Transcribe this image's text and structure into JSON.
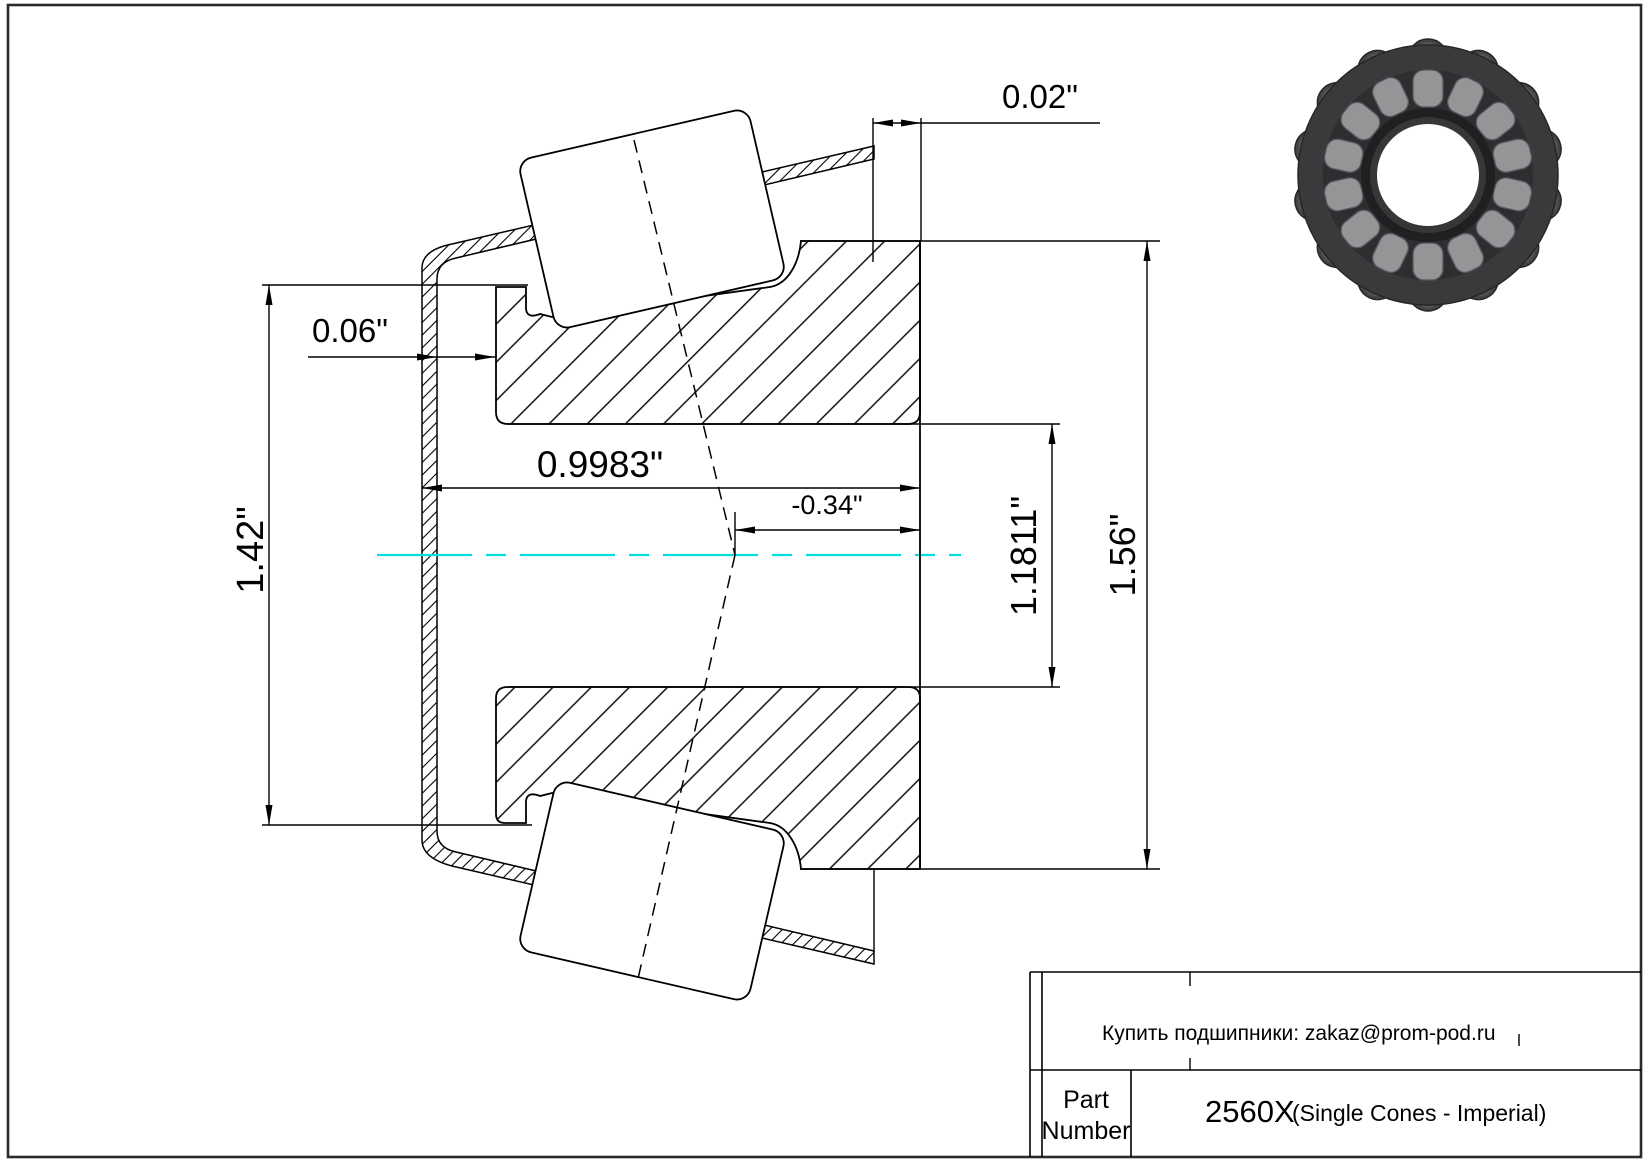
{
  "page": {
    "background": "#ffffff"
  },
  "border": {
    "color": "#2b2b2b"
  },
  "drawing": {
    "centerline_color": "#00dfdf",
    "dims": {
      "cage_clearance": "0.02\"",
      "backface_offset": "0.06\"",
      "rib_diameter": "1.42\"",
      "bore_width": "0.9983\"",
      "effective_center": "-0.34\"",
      "bore_diameter": "1.1811\"",
      "outer_diameter": "1.56\""
    }
  },
  "title_block": {
    "note": "Купить подшипники: zakaz@prom-pod.ru",
    "part_label_line1": "Part",
    "part_label_line2": "Number",
    "part_number": "2560X",
    "series_note": "(Single Cones - Imperial)"
  }
}
